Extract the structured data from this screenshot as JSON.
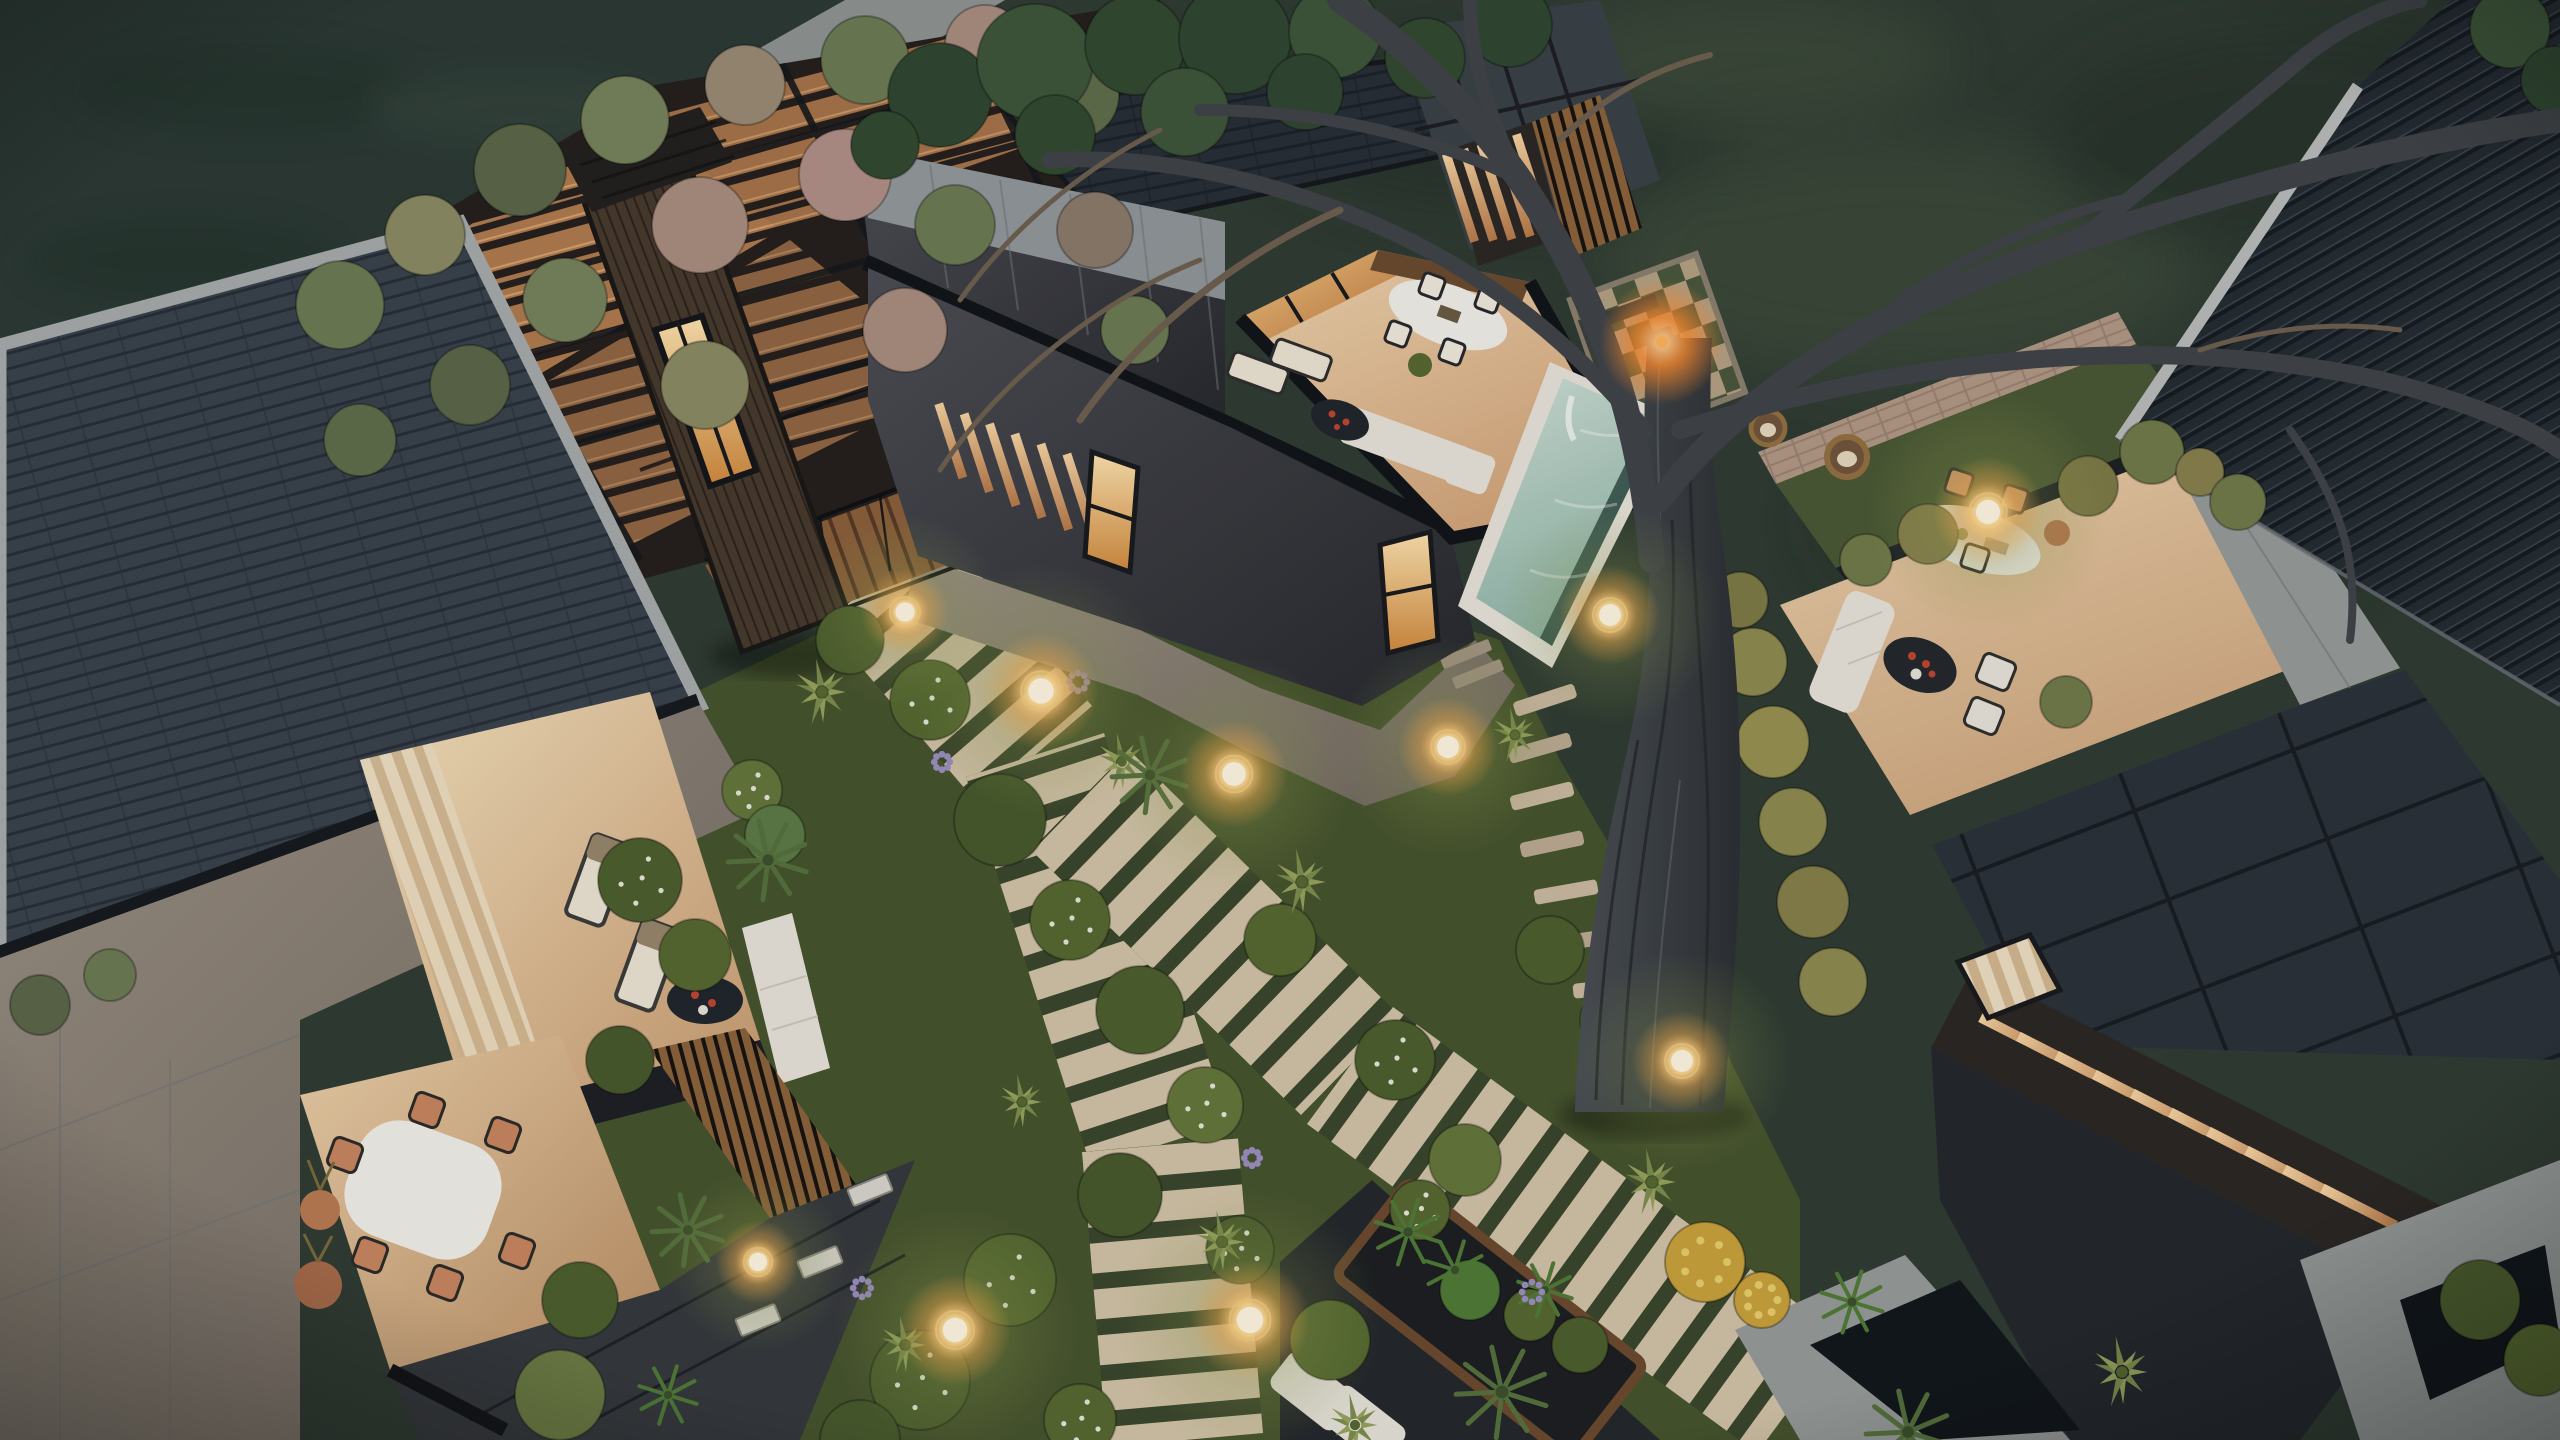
{
  "scene": {
    "subject": "Aerial dusk 3D architectural rendering of a modern dark-clad villa compound with rooftop terraces, a plunge pool, lush landscaped gardens, striped plank walkways, glowing garden lights and a large bare tree",
    "time_of_day": "dusk",
    "camera": "top-down aerial",
    "palette": {
      "scrub": "#2f3b31",
      "scrubDark": "#242e27",
      "lawn": "#2b3933",
      "walkway": "#8f9391",
      "garden": "#45532c",
      "gardenShade": "#39452a",
      "shingle": "#39424b",
      "roofDark": "#272e34",
      "ribbed": "#232a30",
      "panels": "#2b3137",
      "parapet": "#a7abaa",
      "black": "#121417",
      "concreteWall": "#9ba1a3",
      "charcoalWall": "#43464c",
      "wallTaupe": "#8a8074",
      "apron": "#8a7b6d",
      "towerWood": "#46382c",
      "deckWood": "#8a5f3a",
      "slatWood": "#8a6238",
      "terraceC": "#ecd2ad",
      "terraceD": "#e7cba6",
      "roomFloor": "#f4ddb6",
      "poolWater": "#a9cdbf",
      "poolCoping": "#e8e4da",
      "poolRim": "#2e4a42",
      "plank": "#d2c3a6",
      "stone": "#cbb9a0",
      "brick": "#b29884",
      "grassStrip": "#4a5833",
      "slabGray": "#969a98",
      "slabDark": "#11161a",
      "trunk": "#3e4347",
      "glow": "#ffc96b",
      "glowCore": "#fff6e0",
      "windowWarm": "#f3c98a",
      "curtain": "#eedfc2",
      "sofaWhite": "#e9e4d9",
      "tableWhite": "#f2efe8",
      "furnitureDark": "#23262b",
      "terracotta": "#b97a50",
      "flowerRed": "#c0442f",
      "yellowBush": "#c9a23a",
      "allium": "#9a8fc0",
      "agave": "#7c8c4c",
      "palm": "#55703c",
      "fern": "#4e7a35"
    },
    "features": {
      "left_building": "flat shingle roof with light parapet, warm lit lounge with curtains, loungers and white sofa, lower dining terrace with white table and patterned chairs, dark service roof with vent grilles",
      "tower": "dark timber elevator/stair tower with lit glazing and deck bridge",
      "central_villa": "concrete upper volume, rooftop terrace with oval dining table, loungers, white sofa, dark coffee table with red flowers, plunge pool with white coping, lit louvre facade, fire-pit court with checkered paving",
      "right_villa": "walled garden lounge with oval table, white sofas, hanging rattan egg chairs, wood deck wall, brick boundary wall with globe lamp, dark panel roofs with lit louvre band, large ribbed roof",
      "garden": "winding striped plank paths, stepping stones, clipped bushes with white flowers, agaves, fan palms, ferns, allium, golden hedge, glowing sphere lights",
      "tree": "large bare-branched pine trunk crossing the garden with branches spreading over the roofs"
    },
    "lights": [
      [
        1041,
        691,
        58
      ],
      [
        1234,
        774,
        54
      ],
      [
        1448,
        747,
        50
      ],
      [
        1610,
        615,
        50
      ],
      [
        1988,
        512,
        55
      ],
      [
        1250,
        1320,
        60
      ],
      [
        955,
        1330,
        56
      ],
      [
        1682,
        1061,
        50
      ],
      [
        905,
        612,
        44
      ],
      [
        758,
        1262,
        42
      ]
    ],
    "fire": [
      1662,
      342,
      26
    ],
    "stones": [
      [
        1545,
        700,
        -18
      ],
      [
        1540,
        748,
        -16
      ],
      [
        1542,
        796,
        -14
      ],
      [
        1552,
        844,
        -12
      ],
      [
        1566,
        892,
        -10
      ],
      [
        1584,
        940,
        -8
      ],
      [
        1605,
        988,
        -6
      ],
      [
        1628,
        1034,
        -4
      ]
    ],
    "vegetation": {
      "bushes": [
        [
          640,
          880,
          42,
          "#4c5e2d",
          1
        ],
        [
          695,
          955,
          36,
          "#55682f",
          0
        ],
        [
          752,
          790,
          30,
          "#65763a",
          1
        ],
        [
          850,
          640,
          34,
          "#4c5e2d",
          0
        ],
        [
          930,
          700,
          40,
          "#55682f",
          1
        ],
        [
          1000,
          820,
          46,
          "#46582b",
          0
        ],
        [
          1070,
          920,
          40,
          "#55682f",
          1
        ],
        [
          1140,
          1010,
          44,
          "#4c5e2d",
          0
        ],
        [
          1205,
          1105,
          38,
          "#65763a",
          1
        ],
        [
          1120,
          1195,
          42,
          "#46582b",
          0
        ],
        [
          1010,
          1280,
          46,
          "#55682f",
          1
        ],
        [
          920,
          1380,
          50,
          "#4c5e2d",
          1
        ],
        [
          1280,
          940,
          36,
          "#55682f",
          0
        ],
        [
          1395,
          1060,
          40,
          "#4c5e2d",
          1
        ],
        [
          1465,
          1160,
          36,
          "#65763a",
          0
        ],
        [
          860,
          1440,
          40,
          "#46582b",
          0
        ],
        [
          1080,
          1420,
          36,
          "#55682f",
          1
        ],
        [
          1240,
          1250,
          34,
          "#4c5e2d",
          1
        ],
        [
          1330,
          1340,
          40,
          "#55682f",
          0
        ],
        [
          620,
          1060,
          34,
          "#46582b",
          0
        ],
        [
          580,
          1300,
          38,
          "#4c5e2d",
          0
        ],
        [
          1550,
          950,
          34,
          "#4c5e2d",
          0
        ],
        [
          1610,
          1020,
          30,
          "#55682f",
          1
        ],
        [
          1420,
          1210,
          30,
          "#55682f",
          1
        ],
        [
          2480,
          1300,
          40,
          "#4c5e2d",
          0
        ],
        [
          2540,
          1360,
          36,
          "#55682f",
          0
        ],
        [
          40,
          1005,
          30,
          "#5a6647",
          0
        ],
        [
          110,
          975,
          26,
          "#6c7a52",
          0
        ],
        [
          2510,
          28,
          40,
          "#3d5638",
          0
        ],
        [
          2555,
          80,
          34,
          "#2f4630",
          0
        ]
      ],
      "pergola_foliage": [
        [
          340,
          305,
          44,
          "#6c7a52",
          0
        ],
        [
          425,
          235,
          40,
          "#8a8a62",
          0
        ],
        [
          520,
          170,
          46,
          "#5a6647",
          0
        ],
        [
          625,
          120,
          44,
          "#76825a",
          0
        ],
        [
          745,
          85,
          40,
          "#9a8a74",
          0
        ],
        [
          865,
          60,
          44,
          "#6c7a52",
          0
        ],
        [
          985,
          45,
          40,
          "#a98d7d",
          0
        ],
        [
          1075,
          95,
          44,
          "#5f6d4a",
          0
        ],
        [
          700,
          225,
          48,
          "#a98d7d",
          0
        ],
        [
          565,
          300,
          42,
          "#76825a",
          0
        ],
        [
          845,
          175,
          46,
          "#b09086",
          0
        ],
        [
          955,
          225,
          40,
          "#6c7a52",
          0
        ],
        [
          470,
          385,
          40,
          "#5a6647",
          0
        ],
        [
          705,
          385,
          44,
          "#8a8a62",
          0
        ],
        [
          905,
          330,
          42,
          "#a98d7d",
          0
        ],
        [
          1095,
          230,
          38,
          "#8a7a6a",
          0
        ],
        [
          1135,
          330,
          34,
          "#6c7a52",
          0
        ],
        [
          360,
          440,
          36,
          "#5f6d4a",
          0
        ]
      ],
      "pines": [
        [
          940,
          95,
          52,
          "#2f4630",
          0
        ],
        [
          1035,
          62,
          58,
          "#3d5638",
          0
        ],
        [
          1135,
          45,
          50,
          "#31492f",
          0
        ],
        [
          1235,
          38,
          56,
          "#2f4630",
          0
        ],
        [
          1335,
          32,
          46,
          "#3d5638",
          0
        ],
        [
          1425,
          58,
          40,
          "#31492f",
          0
        ],
        [
          1510,
          25,
          42,
          "#2f4630",
          0
        ],
        [
          1055,
          135,
          40,
          "#31492f",
          0
        ],
        [
          1185,
          112,
          44,
          "#3d5638",
          0
        ],
        [
          1305,
          92,
          38,
          "#2f4630",
          0
        ],
        [
          885,
          145,
          34,
          "#31492f",
          0
        ]
      ],
      "olives": [
        [
          1866,
          560,
          26,
          "#6f7a48",
          0
        ],
        [
          1928,
          534,
          30,
          "#87804c",
          0
        ],
        [
          2152,
          452,
          32,
          "#6f7a48",
          0
        ],
        [
          2200,
          472,
          24,
          "#87804c",
          0
        ],
        [
          2238,
          502,
          28,
          "#6f7a48",
          0
        ],
        [
          2088,
          486,
          30,
          "#7d7a45",
          0
        ],
        [
          2066,
          702,
          26,
          "#6f7a48",
          0
        ]
      ],
      "hedge": [
        [
          1753,
          662,
          34,
          "#8f8a4f",
          0
        ],
        [
          1773,
          742,
          36,
          "#97914f",
          0
        ],
        [
          1793,
          822,
          34,
          "#8f8a4f",
          0
        ],
        [
          1813,
          902,
          36,
          "#857f47",
          0
        ],
        [
          1833,
          982,
          34,
          "#8f8a4f",
          0
        ],
        [
          1740,
          600,
          28,
          "#7d7a45",
          0
        ]
      ],
      "accents": [
        [
          1470,
          1290,
          30,
          "#4e7a35",
          0
        ],
        [
          1530,
          1315,
          26,
          "#55682f",
          0
        ],
        [
          1580,
          1345,
          28,
          "#4c5e2d",
          0
        ],
        [
          560,
          1395,
          45,
          "#6a7a42",
          0
        ],
        [
          775,
          835,
          30,
          "#5d7a45",
          0
        ]
      ],
      "yellow_bushes": [
        [
          1705,
          1262,
          40
        ],
        [
          1762,
          1300,
          28
        ]
      ],
      "agaves": [
        [
          822,
          692,
          34
        ],
        [
          1122,
          762,
          30
        ],
        [
          1302,
          882,
          34
        ],
        [
          1222,
          1242,
          32
        ],
        [
          1022,
          1102,
          28
        ],
        [
          1652,
          1182,
          34
        ],
        [
          2122,
          1372,
          36
        ],
        [
          905,
          1345,
          30
        ],
        [
          1355,
          1425,
          32
        ],
        [
          1515,
          735,
          28
        ]
      ],
      "palms": [
        [
          768,
          860,
          40
        ],
        [
          1502,
          1392,
          46
        ],
        [
          1908,
          1432,
          42
        ],
        [
          688,
          1230,
          36
        ],
        [
          1150,
          775,
          38
        ]
      ],
      "ferns": [
        [
          1408,
          1232,
          34
        ],
        [
          1455,
          1270,
          30
        ],
        [
          1852,
          1302,
          32
        ],
        [
          668,
          1395,
          30
        ],
        [
          1545,
          1290,
          28
        ]
      ],
      "alliums": [
        [
          1078,
          682,
          16
        ],
        [
          942,
          762,
          14
        ],
        [
          1532,
          1292,
          18
        ],
        [
          1252,
          1158,
          14
        ],
        [
          862,
          1288,
          16
        ]
      ]
    }
  }
}
